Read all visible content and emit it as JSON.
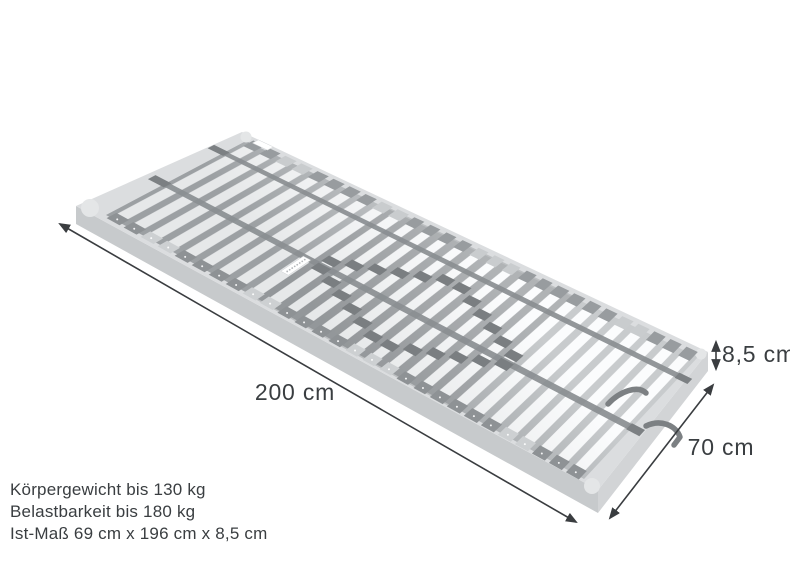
{
  "scene": {
    "background": "#ffffff",
    "product": "slatted-bed-base-3d-view",
    "slat_count": 28,
    "colors": {
      "frame_top": "#dbdddf",
      "frame_side_near": "#c7cacc",
      "frame_side_foot": "#d2d4d6",
      "frame_corner": "#e4e6e7",
      "inner_near": "#9ca0a3",
      "inner_far": "#c8cbcd",
      "middle_zone_shadow": "#83878a",
      "slat_near": "#e6e8e9",
      "slat_far": "#fbfcfd",
      "slat_edge": "#d4d6d8",
      "holder_dark": "#8e9295",
      "holder_light": "#cdd0d2",
      "holder_far_dark": "#989c9f",
      "holder_far_light": "#c9ccce",
      "strap": "#8a8e91",
      "slider_tab": "#7a7e81",
      "hook": "#7c8083",
      "label_tag": "#ffffff",
      "annotation": "#3a3d40",
      "text": "#3a3e41"
    }
  },
  "dimensions": {
    "length": {
      "label": "200 cm"
    },
    "width": {
      "label": "70 cm"
    },
    "height": {
      "label": "8,5 cm"
    }
  },
  "specs": {
    "lines": [
      "Körpergewicht bis 130 kg",
      "Belastbarkeit bis 180 kg",
      "Ist-Maß 69 cm x 196 cm x 8,5 cm"
    ]
  }
}
